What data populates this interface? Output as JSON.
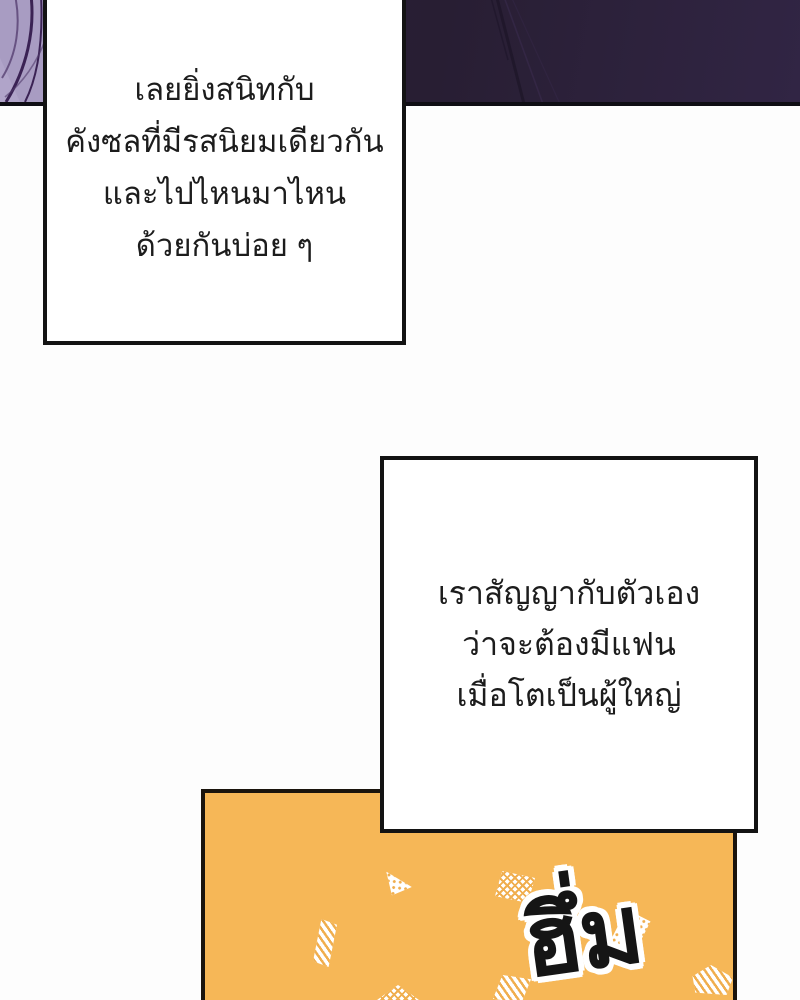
{
  "page": {
    "type": "webtoon comic page",
    "language": "th"
  },
  "colors": {
    "top_panel_dark_purple": "#2b2037",
    "top_panel_streak": "#1d1528",
    "left_art_light_purple": "#a89cc2",
    "left_art_stroke_dark_purple": "#3a2254",
    "orange_panel": "#f6b757",
    "confetti_white": "#ffffff",
    "bubble_background": "#ffffff",
    "panel_border_black": "#131313",
    "text_black": "#1c1c1c"
  },
  "bubbles": [
    {
      "lines": [
        "เลยยิ่งสนิทกับ",
        "คังซลที่มีรสนิยมเดียวกัน",
        "และไปไหนมาไหน",
        "ด้วยกันบ่อย ๆ"
      ]
    },
    {
      "lines": [
        "เราสัญญากับตัวเอง",
        "ว่าจะต้องมีแฟน",
        "เมื่อโตเป็นผู้ใหญ่"
      ]
    }
  ],
  "sfx": {
    "text": "ฮึ่ม"
  }
}
